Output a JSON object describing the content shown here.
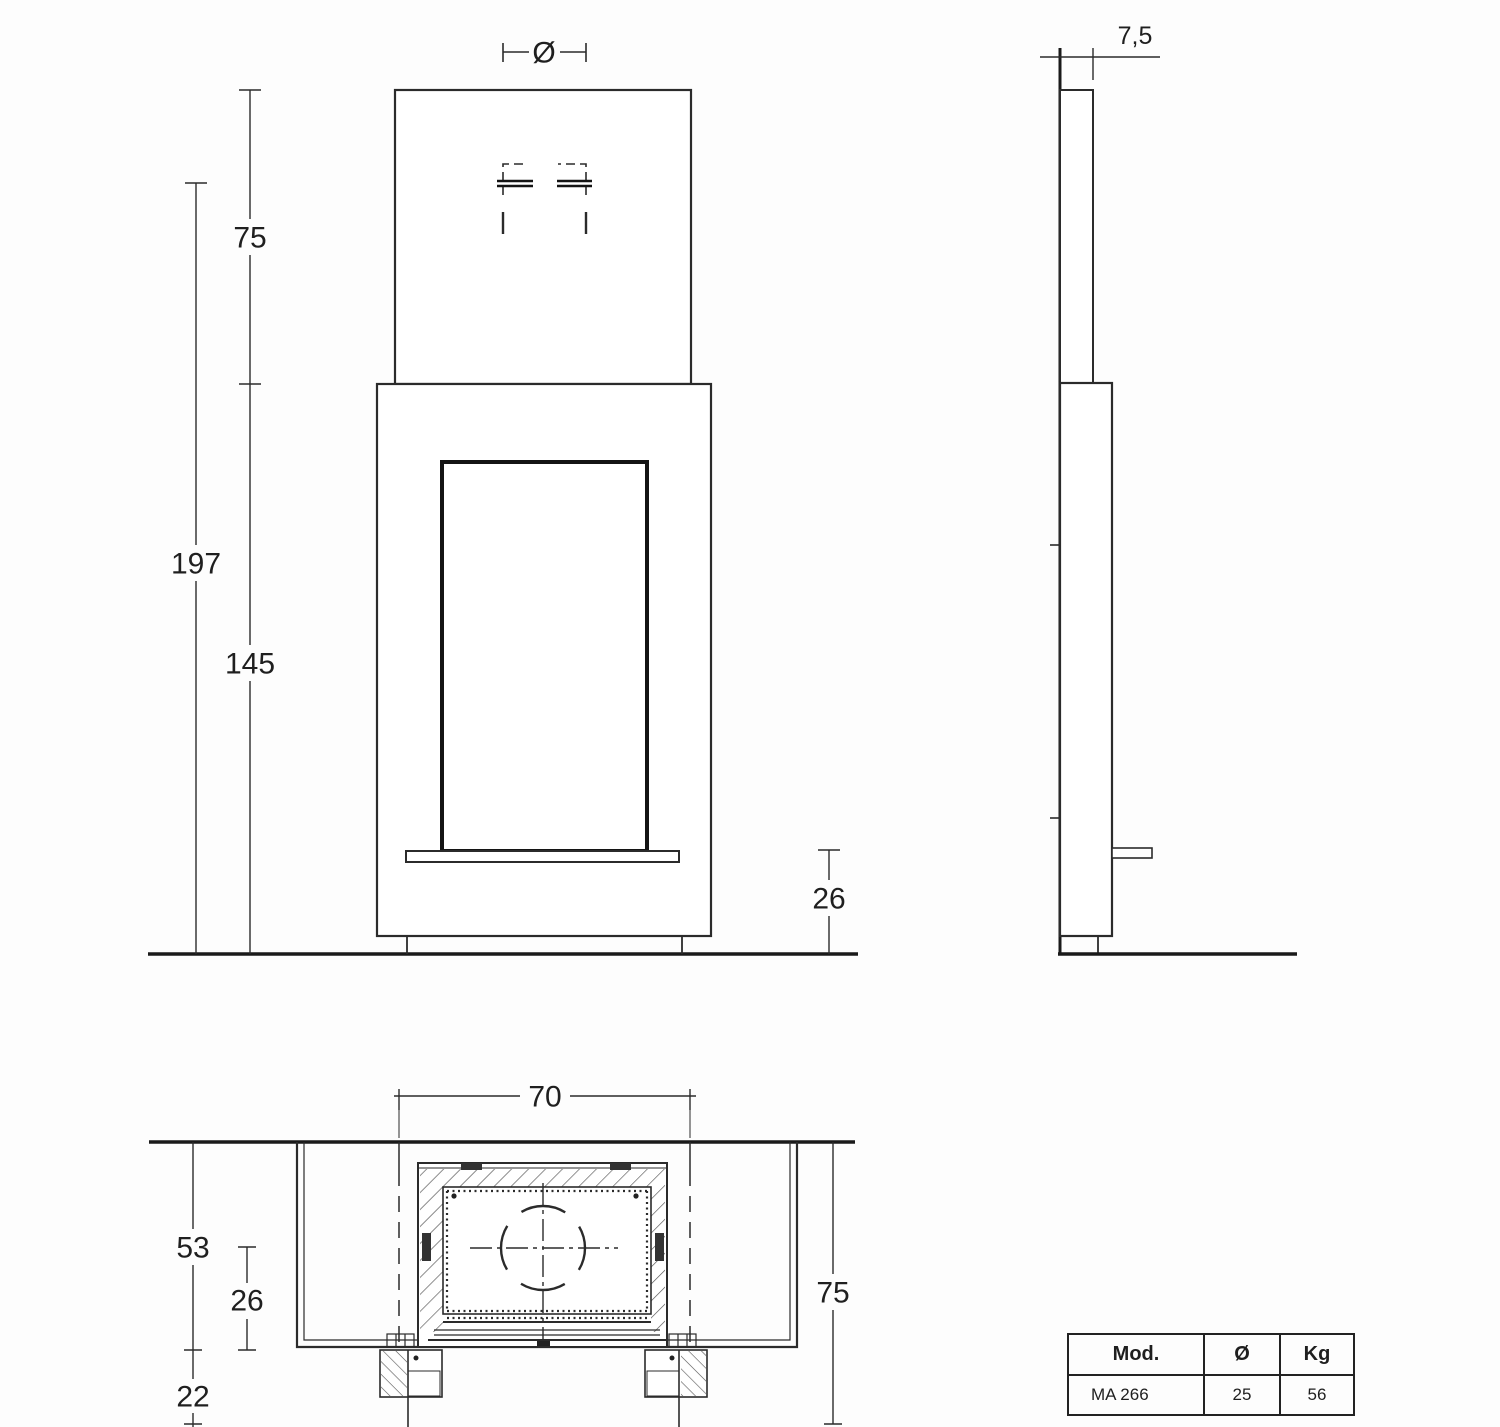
{
  "drawing": {
    "line_color": "#2b2b2b",
    "front_view": {
      "flue_diameter_symbol": "Ø",
      "chimney_height": "75",
      "total_height": "197",
      "body_height": "145",
      "hearth_height": "26"
    },
    "side_view": {
      "wall_clearance": "7,5"
    },
    "plan_view": {
      "front_width": "70",
      "wall_to_front_depth": "53",
      "flue_center_offset": "26",
      "hearth_overhang": "22",
      "total_depth": "75"
    },
    "spec_table": {
      "headers": [
        "Mod.",
        "Ø",
        "Kg"
      ],
      "rows": [
        [
          "MA 266",
          "25",
          "56"
        ]
      ]
    }
  }
}
